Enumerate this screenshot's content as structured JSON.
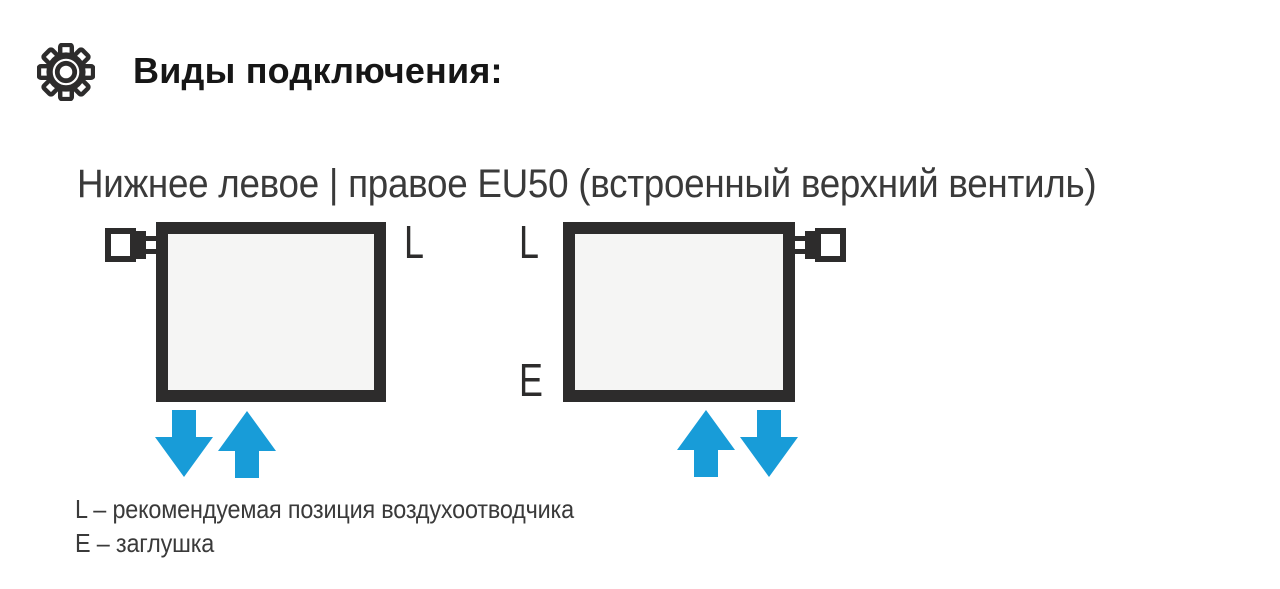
{
  "header": {
    "icon": "gear-icon",
    "title": "Виды подключения:"
  },
  "section": {
    "subtitle": "Нижнее левое | правое EU50 (встроенный верхний вентиль)"
  },
  "diagram": {
    "left_radiator": {
      "valve_position": "top-left",
      "label_top_right": "L",
      "flow_arrows": [
        "down",
        "up"
      ]
    },
    "right_radiator": {
      "valve_position": "top-right",
      "label_top_left": "L",
      "label_bottom_left": "E",
      "flow_arrows": [
        "up",
        "down"
      ]
    }
  },
  "legend": {
    "lines": [
      "L – рекомендуемая позиция воздухоотводчика",
      "E – заглушка"
    ]
  },
  "colors": {
    "ink": "#2d2c2c",
    "accent_blue": "#189cd8",
    "radiator_fill": "#f5f5f4",
    "text": "#3a3a3a",
    "title": "#161616"
  }
}
